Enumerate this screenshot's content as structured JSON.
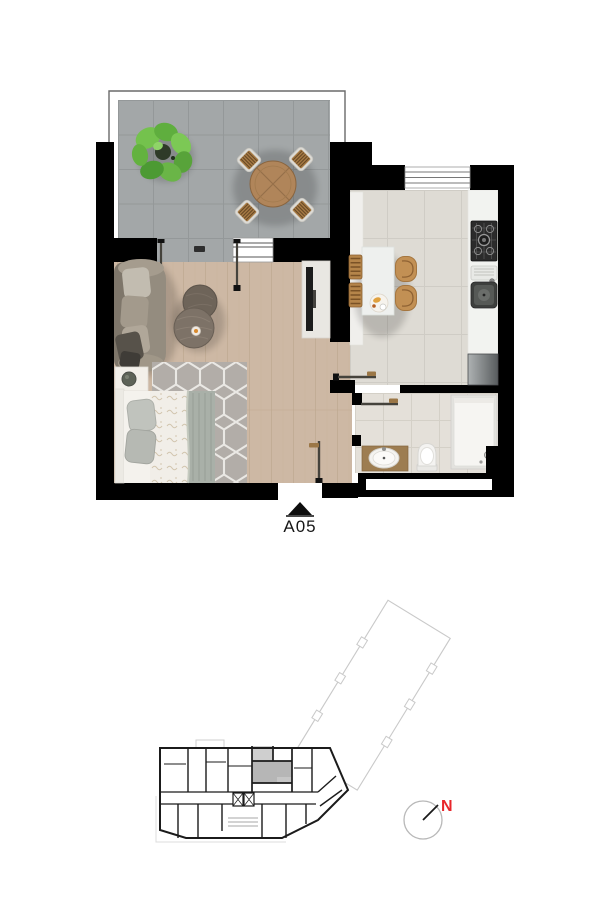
{
  "page": {
    "title": "Apartment floor plan with unit location key"
  },
  "unit": {
    "label": "A05"
  },
  "compass": {
    "label": "N"
  },
  "colors": {
    "wall": "#000000",
    "label_ink": "#161616",
    "accent_red": "#e8262b",
    "terrace_tile": "#a3a7a8",
    "terrace_grout": "#91969­7",
    "wood_floor": "#cdb8a4",
    "wood_seam": "#bda78e",
    "kitchen_tile": "#dedbd4",
    "kitchen_grout": "#cfccc5",
    "bath_tile": "#e4e0d9",
    "bath_grout": "#d4d0c7",
    "rug": "#b2adA8",
    "rug_line": "#eae8e4",
    "door_line": "#45433c",
    "handle": "#9b7747",
    "key_line": "#1b1b1b",
    "key_light": "#c9c9c9",
    "key_highlight": "#b6b6b6",
    "key_highlight_light": "#cfcfcf",
    "plant_green": "#6ab547",
    "table_wood": "#b0855a",
    "chair_wood": "#a87c46",
    "stool_wood": "#c29054",
    "sofa_body": "#948c7f",
    "counter_white": "#f2f3f0",
    "railing": "#6a6a6a"
  },
  "plan": {
    "rooms": [
      "terrace",
      "living-room",
      "sleeping-area",
      "hall",
      "kitchen",
      "bathroom"
    ],
    "furniture": {
      "terrace": [
        "plant",
        "round-dining-table",
        "chair",
        "chair",
        "chair",
        "chair"
      ],
      "living": [
        "sofa",
        "coffee-tables",
        "tv-cabinet",
        "rug",
        "bed",
        "nightstand"
      ],
      "kitchen": [
        "island-table",
        "dining-chair",
        "dining-chair",
        "bar-stool",
        "bar-stool",
        "gas-hob",
        "kitchen-sink",
        "fridge",
        "counter"
      ],
      "bathroom": [
        "vanity-sink",
        "toilet",
        "shower"
      ]
    },
    "openings": [
      "entry-door",
      "kitchen-door",
      "bathroom-door",
      "sliding-door-panels",
      "terrace-window",
      "kitchen-window"
    ]
  },
  "key_plan": {
    "highlighted_unit": "A05"
  }
}
